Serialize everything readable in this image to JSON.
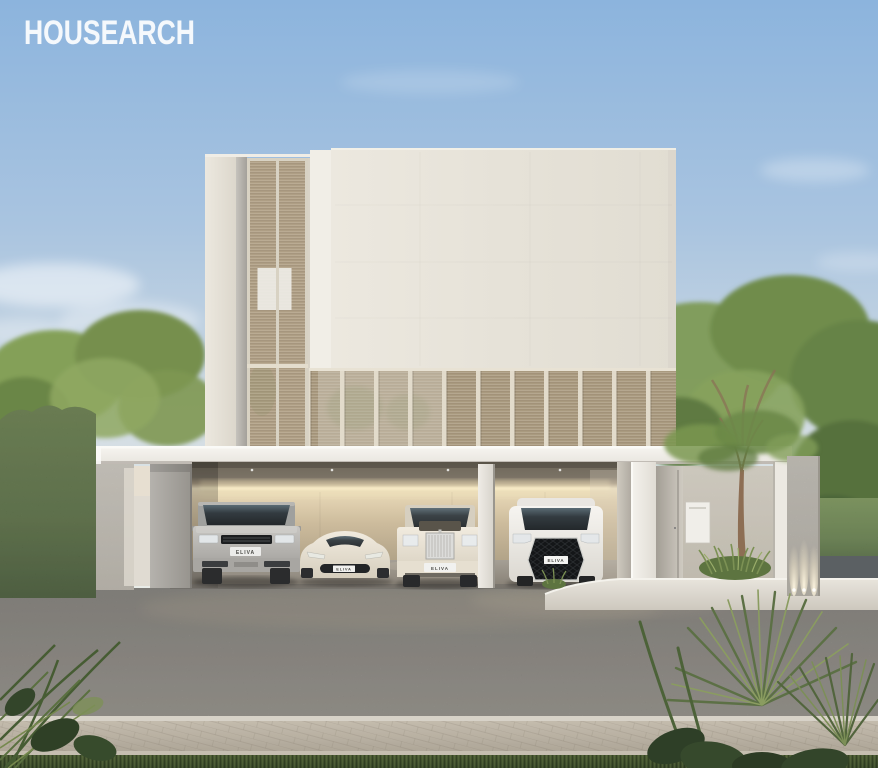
{
  "watermark": {
    "brand": "HOUSEARCH"
  },
  "vehicles": {
    "suv_plate": "ELIVA",
    "sports_car_plate": "ELIVA",
    "sedan_plate": "ELIVA",
    "minivan_plate": "ELIVA"
  },
  "palette": {
    "sky_top": "#8cb4dd",
    "sky_horizon": "#edefe9",
    "facade_cream": "#e6e2d8",
    "louver_beige": "#ad9d82",
    "canopy_white": "#f3f1ec",
    "garage_glow": "#f0e2c0",
    "asphalt_gray": "#87837e",
    "sidewalk_beige": "#b3aa9b",
    "grass_green": "#44522f",
    "hedge_green": "#57703f",
    "tree_green": "#7d9a55",
    "watermark_white": "#ffffff"
  }
}
